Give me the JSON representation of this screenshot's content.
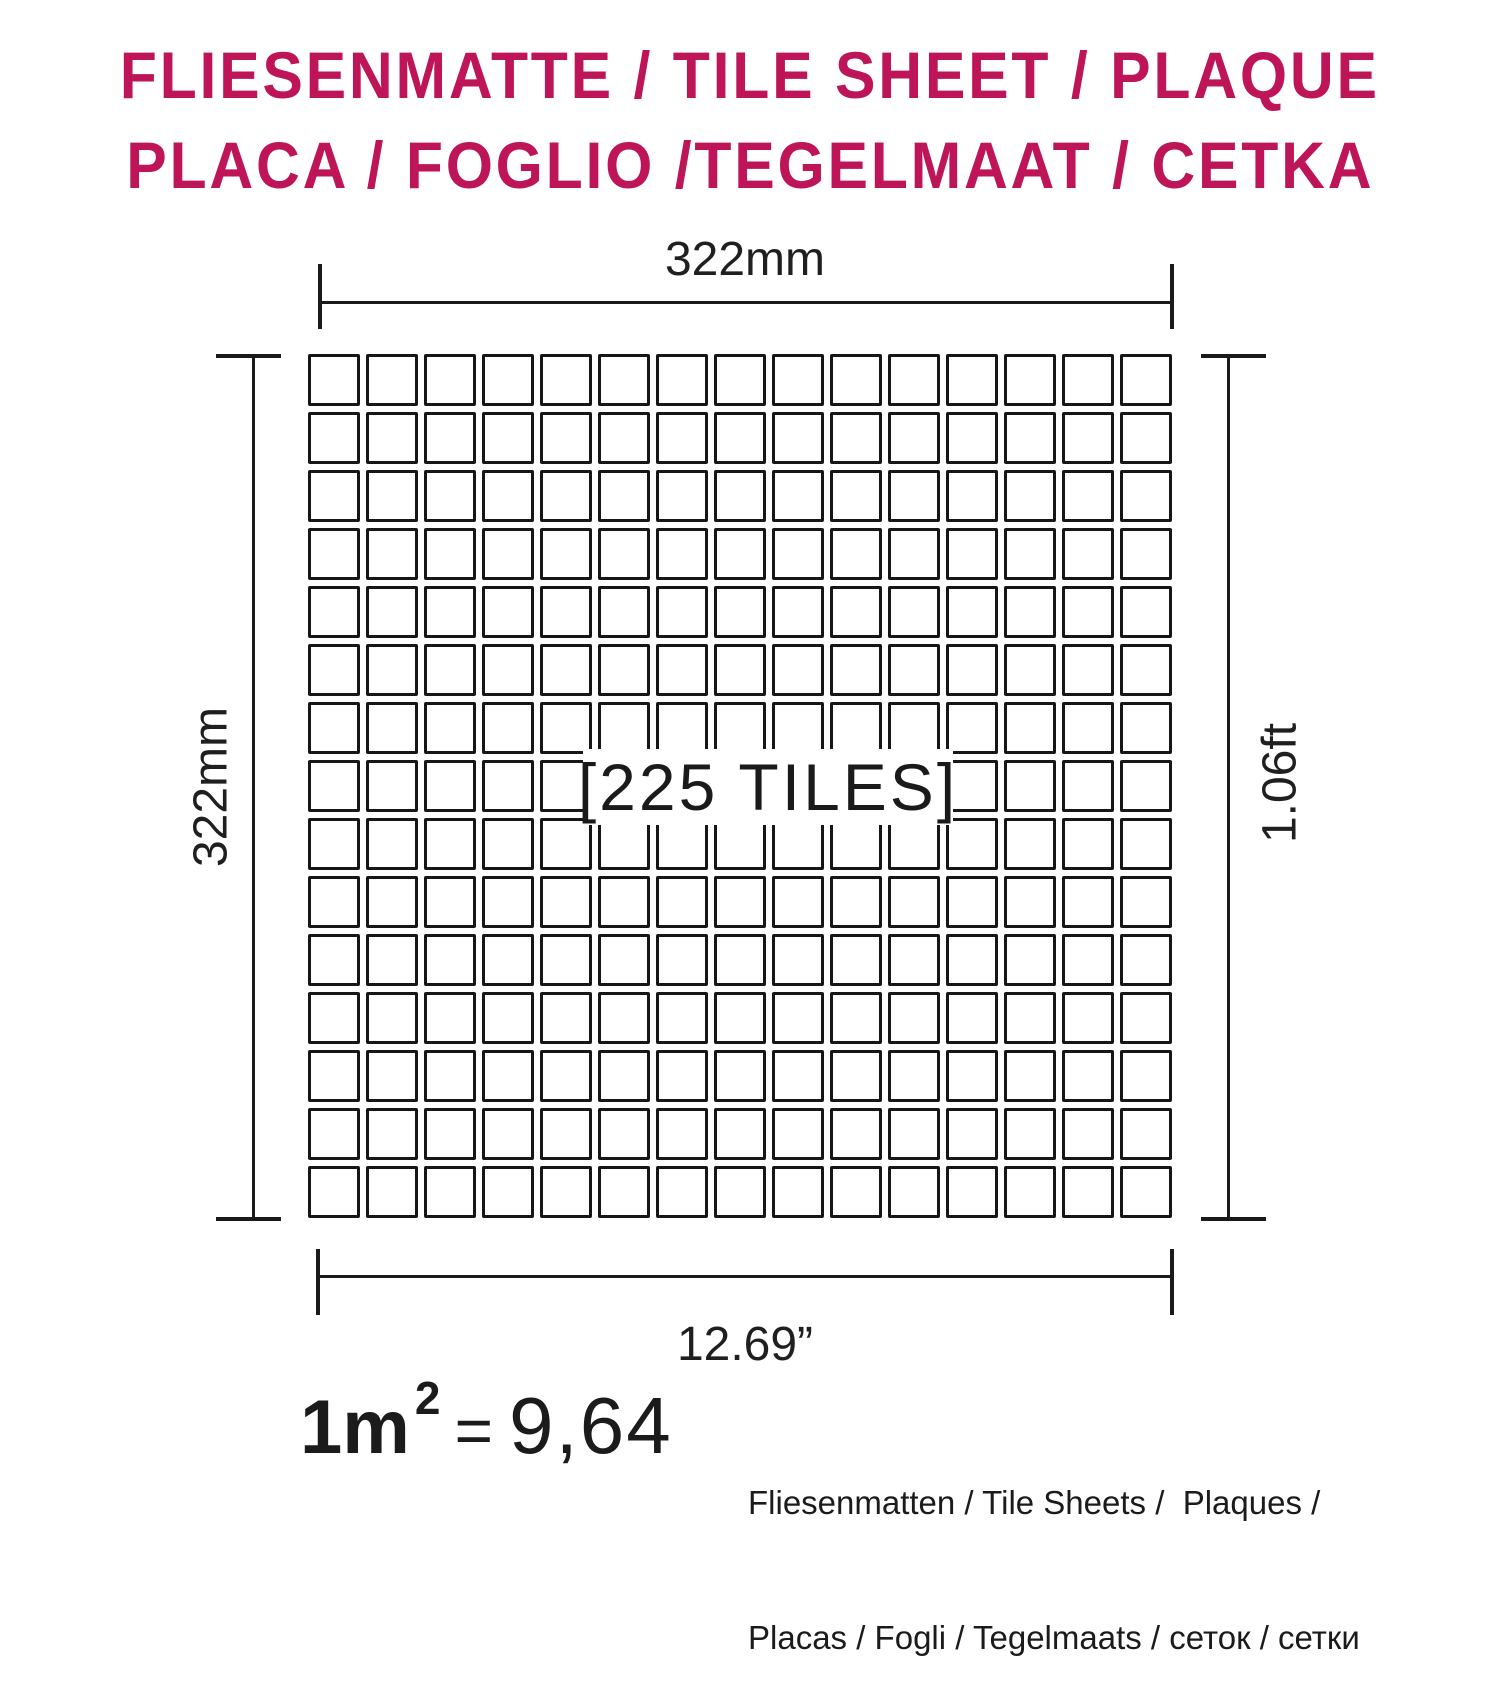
{
  "page": {
    "background": "#ffffff"
  },
  "title": {
    "line1": "FLIESENMATTE / TILE SHEET / PLAQUE",
    "line2": "PLACA / FOGLIO /TEGELMAAT / CETKA",
    "color": "#BE1458"
  },
  "diagram": {
    "grid": {
      "rows": 15,
      "cols": 15,
      "tiles_total": 225
    },
    "center_label": "[225 TILES]",
    "dim_top": "322mm",
    "dim_left": "322mm",
    "dim_right": "1.06ft",
    "dim_bottom": "12.69”",
    "line_color": "#1a1a1a"
  },
  "footer": {
    "area_base": "1m",
    "area_exponent": "2",
    "equals": "=",
    "sheets_per_sqm": "9,64",
    "caption_line1": "Fliesenmatten / Tile Sheets /  Plaques /",
    "caption_line2": "Placas / Fogli / Tegelmaats / сеток / сетки"
  }
}
